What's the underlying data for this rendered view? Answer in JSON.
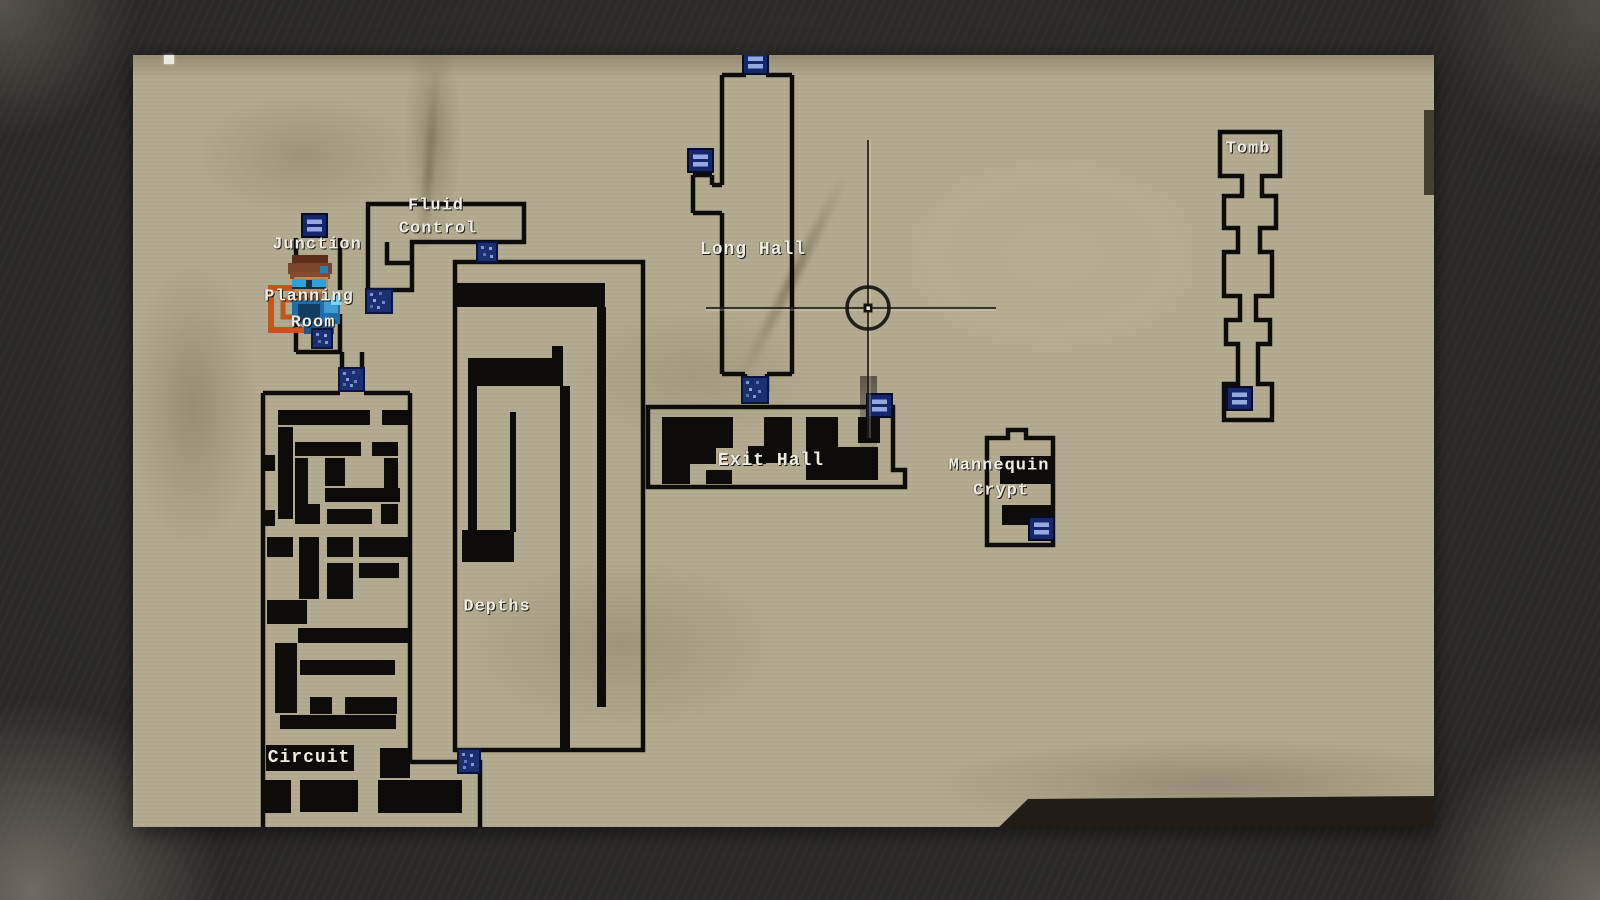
{
  "screen": {
    "type": "game-map-screen",
    "cursor": "crosshair"
  },
  "rooms": {
    "junction": {
      "label": "Junction"
    },
    "fluid_control": {
      "line1": "Fluid",
      "line2": "Control"
    },
    "planning_room": {
      "line1": "Planning",
      "line2": "Room"
    },
    "long_hall": {
      "label": "Long Hall"
    },
    "depths": {
      "label": "Depths"
    },
    "circuit": {
      "label": "Circuit"
    },
    "exit_hall": {
      "label": "Exit Hall"
    },
    "mannequin_crypt": {
      "line1": "Mannequin",
      "line2": "Crypt"
    },
    "tomb": {
      "label": "Tomb"
    }
  },
  "markers": {
    "doors": [
      "junction-north",
      "long-hall-north",
      "long-hall-west",
      "long-hall-south",
      "exit-hall-east",
      "fluid-control-south",
      "fluid-control-depths",
      "planning-room-inner",
      "corridor-circuit",
      "depths-circuit",
      "mannequin-crypt-south",
      "tomb-south"
    ],
    "door_fill": "#16266b",
    "door_glyph": "#96a8e0",
    "objective_frame": "#c2571d"
  },
  "player": {
    "location": "Planning Room"
  },
  "palette": {
    "paper": "#b3ab90",
    "wall": "#0d0c0a",
    "background": "#2a2927",
    "label_text": "#efece2"
  }
}
